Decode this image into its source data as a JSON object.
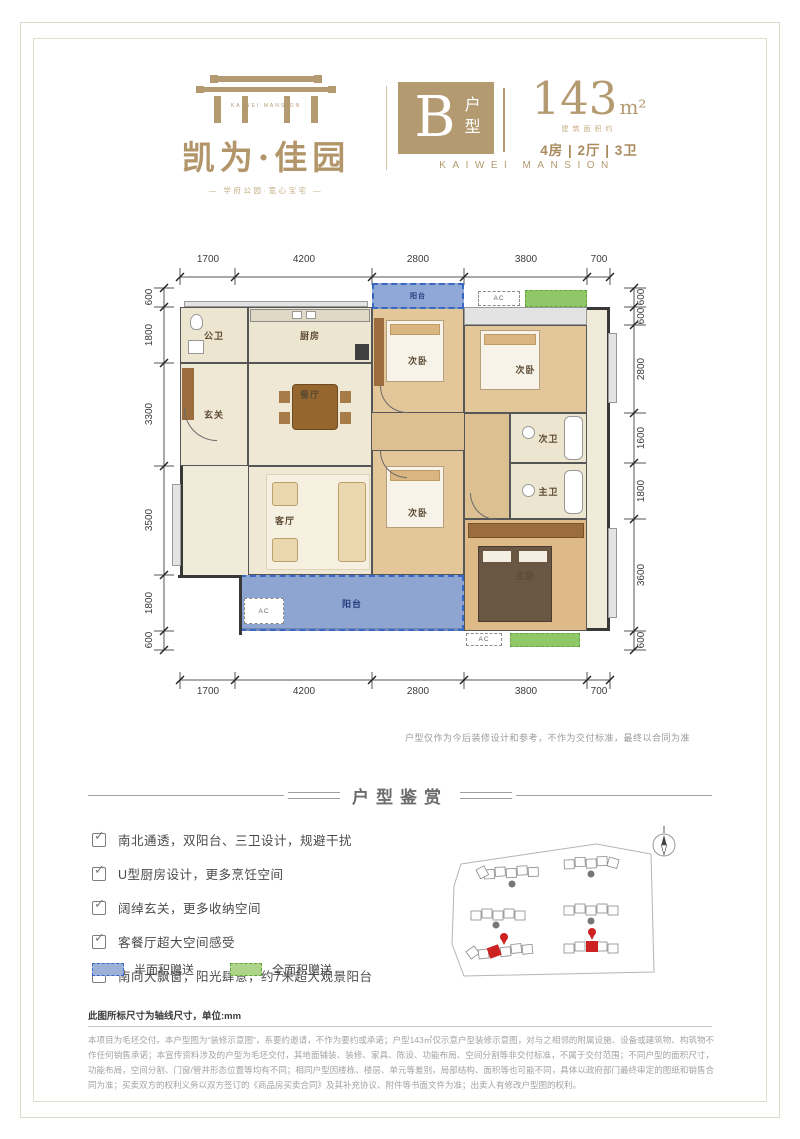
{
  "header": {
    "logo": {
      "brand_en": "KAIWEI MANSION",
      "brand_cn": "凯为·佳园",
      "tagline": "— 学府公园·宽心宝宅 —"
    },
    "unit": {
      "letter": "B",
      "type_label": "户型",
      "area": "143",
      "area_unit": "m²",
      "area_note": "建筑面积约",
      "rooms": "4房 | 2厅 | 3卫",
      "brand_en": "KAIWEI MANSION"
    }
  },
  "floorplan": {
    "dims_top": [
      "1700",
      "4200",
      "2800",
      "3800",
      "700"
    ],
    "dims_bottom": [
      "1700",
      "4200",
      "2800",
      "3800",
      "700"
    ],
    "dims_left": [
      "600",
      "1800",
      "3300",
      "3500",
      "1800",
      "600"
    ],
    "dims_right": [
      "600",
      "600",
      "2800",
      "1600",
      "1800",
      "3600",
      "600"
    ],
    "rooms": {
      "guest_bath": "公卫",
      "kitchen": "厨房",
      "dining": "餐厅",
      "entry": "玄关",
      "living": "客厅",
      "bedroom": "次卧",
      "bath2": "次卫",
      "master_bath": "主卫",
      "master_bedroom": "主卧",
      "balcony": "阳台",
      "ac": "AC"
    },
    "note": "户型仅作为今后装修设计和参考，不作为交付标准，最终以合同为准"
  },
  "section": {
    "title": "户型鉴赏",
    "features": [
      "南北通透，双阳台、三卫设计，规避干扰",
      "U型厨房设计，更多烹饪空间",
      "阔绰玄关，更多收纳空间",
      "客餐厅超大空间感受",
      "南向大飘窗，阳光肆意，约7米超大观景阳台"
    ],
    "legend": [
      {
        "label": "半面积赠送",
        "fill": "#9cb0d8",
        "border": "#3a66c4"
      },
      {
        "label": "全面积赠送",
        "fill": "#aed489",
        "border": "#64a53d"
      }
    ],
    "dim_note": "此图所标尺寸为轴线尺寸，单位:mm",
    "fine_print": "本项目为毛坯交付。本户型图为“装修示意图”，系要约邀请，不作为要约或承诺；户型143㎡仅示意户型装修示意图，对与之相邻的附属设施、设备或建筑物、构筑物不作任何销售承诺；本宣传资料涉及的户型为毛坯交付，其地面铺装、装修、家具、陈设、功能布局、空间分割等非交付标准，不属于交付范围；不同户型的面积尺寸，功能布局，空间分割、门窗/管井形态位置等均有不同；相同户型因楼栋、楼层、单元等差别，局部结构、面积等也可能不同，具体以政府部门最终审定的图纸和销售合同为准；买卖双方的权利义务以双方签订的《商品房买卖合同》及其补充协议、附件等书面文件为准；出卖人有修改户型图的权利。"
  },
  "colors": {
    "brand_tan": "#b49a70",
    "balcony_blue_fill": "#7d99cf",
    "balcony_blue_border": "#3a66c4",
    "gift_green_fill": "#8fc769",
    "gift_green_border": "#64a53d",
    "wall": "#383838",
    "marker_red": "#cc2222"
  }
}
